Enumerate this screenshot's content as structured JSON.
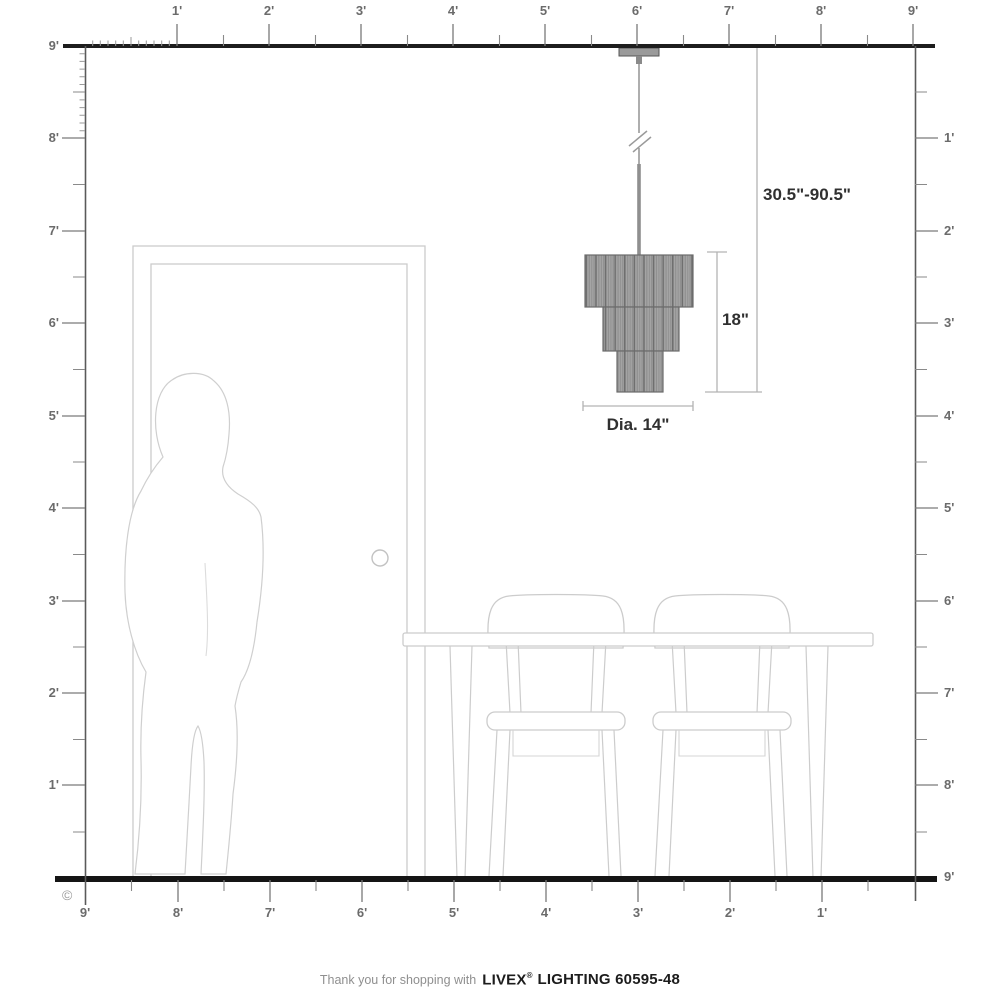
{
  "copyright_symbol": "©",
  "rulers": {
    "unit": "feet",
    "top": {
      "labels": [
        "1'",
        "2'",
        "3'",
        "4'",
        "5'",
        "6'",
        "7'",
        "8'",
        "9'"
      ]
    },
    "left": {
      "labels": [
        "9'",
        "8'",
        "7'",
        "6'",
        "5'",
        "4'",
        "3'",
        "2'",
        "1'"
      ]
    },
    "right": {
      "labels": [
        "1'",
        "2'",
        "3'",
        "4'",
        "5'",
        "6'",
        "7'",
        "8'",
        "9'"
      ]
    },
    "bottom": {
      "labels": [
        "9'",
        "8'",
        "7'",
        "6'",
        "5'",
        "4'",
        "3'",
        "2'",
        "1'"
      ]
    }
  },
  "dimensions": {
    "hanging_height_range": "30.5\"-90.5\"",
    "fixture_height": "18\"",
    "fixture_diameter": "Dia. 14\""
  },
  "footer": {
    "message": "Thank you for shopping with",
    "brand": "LIVEX",
    "registered_mark": "®",
    "product": "LIGHTING 60595-48"
  }
}
